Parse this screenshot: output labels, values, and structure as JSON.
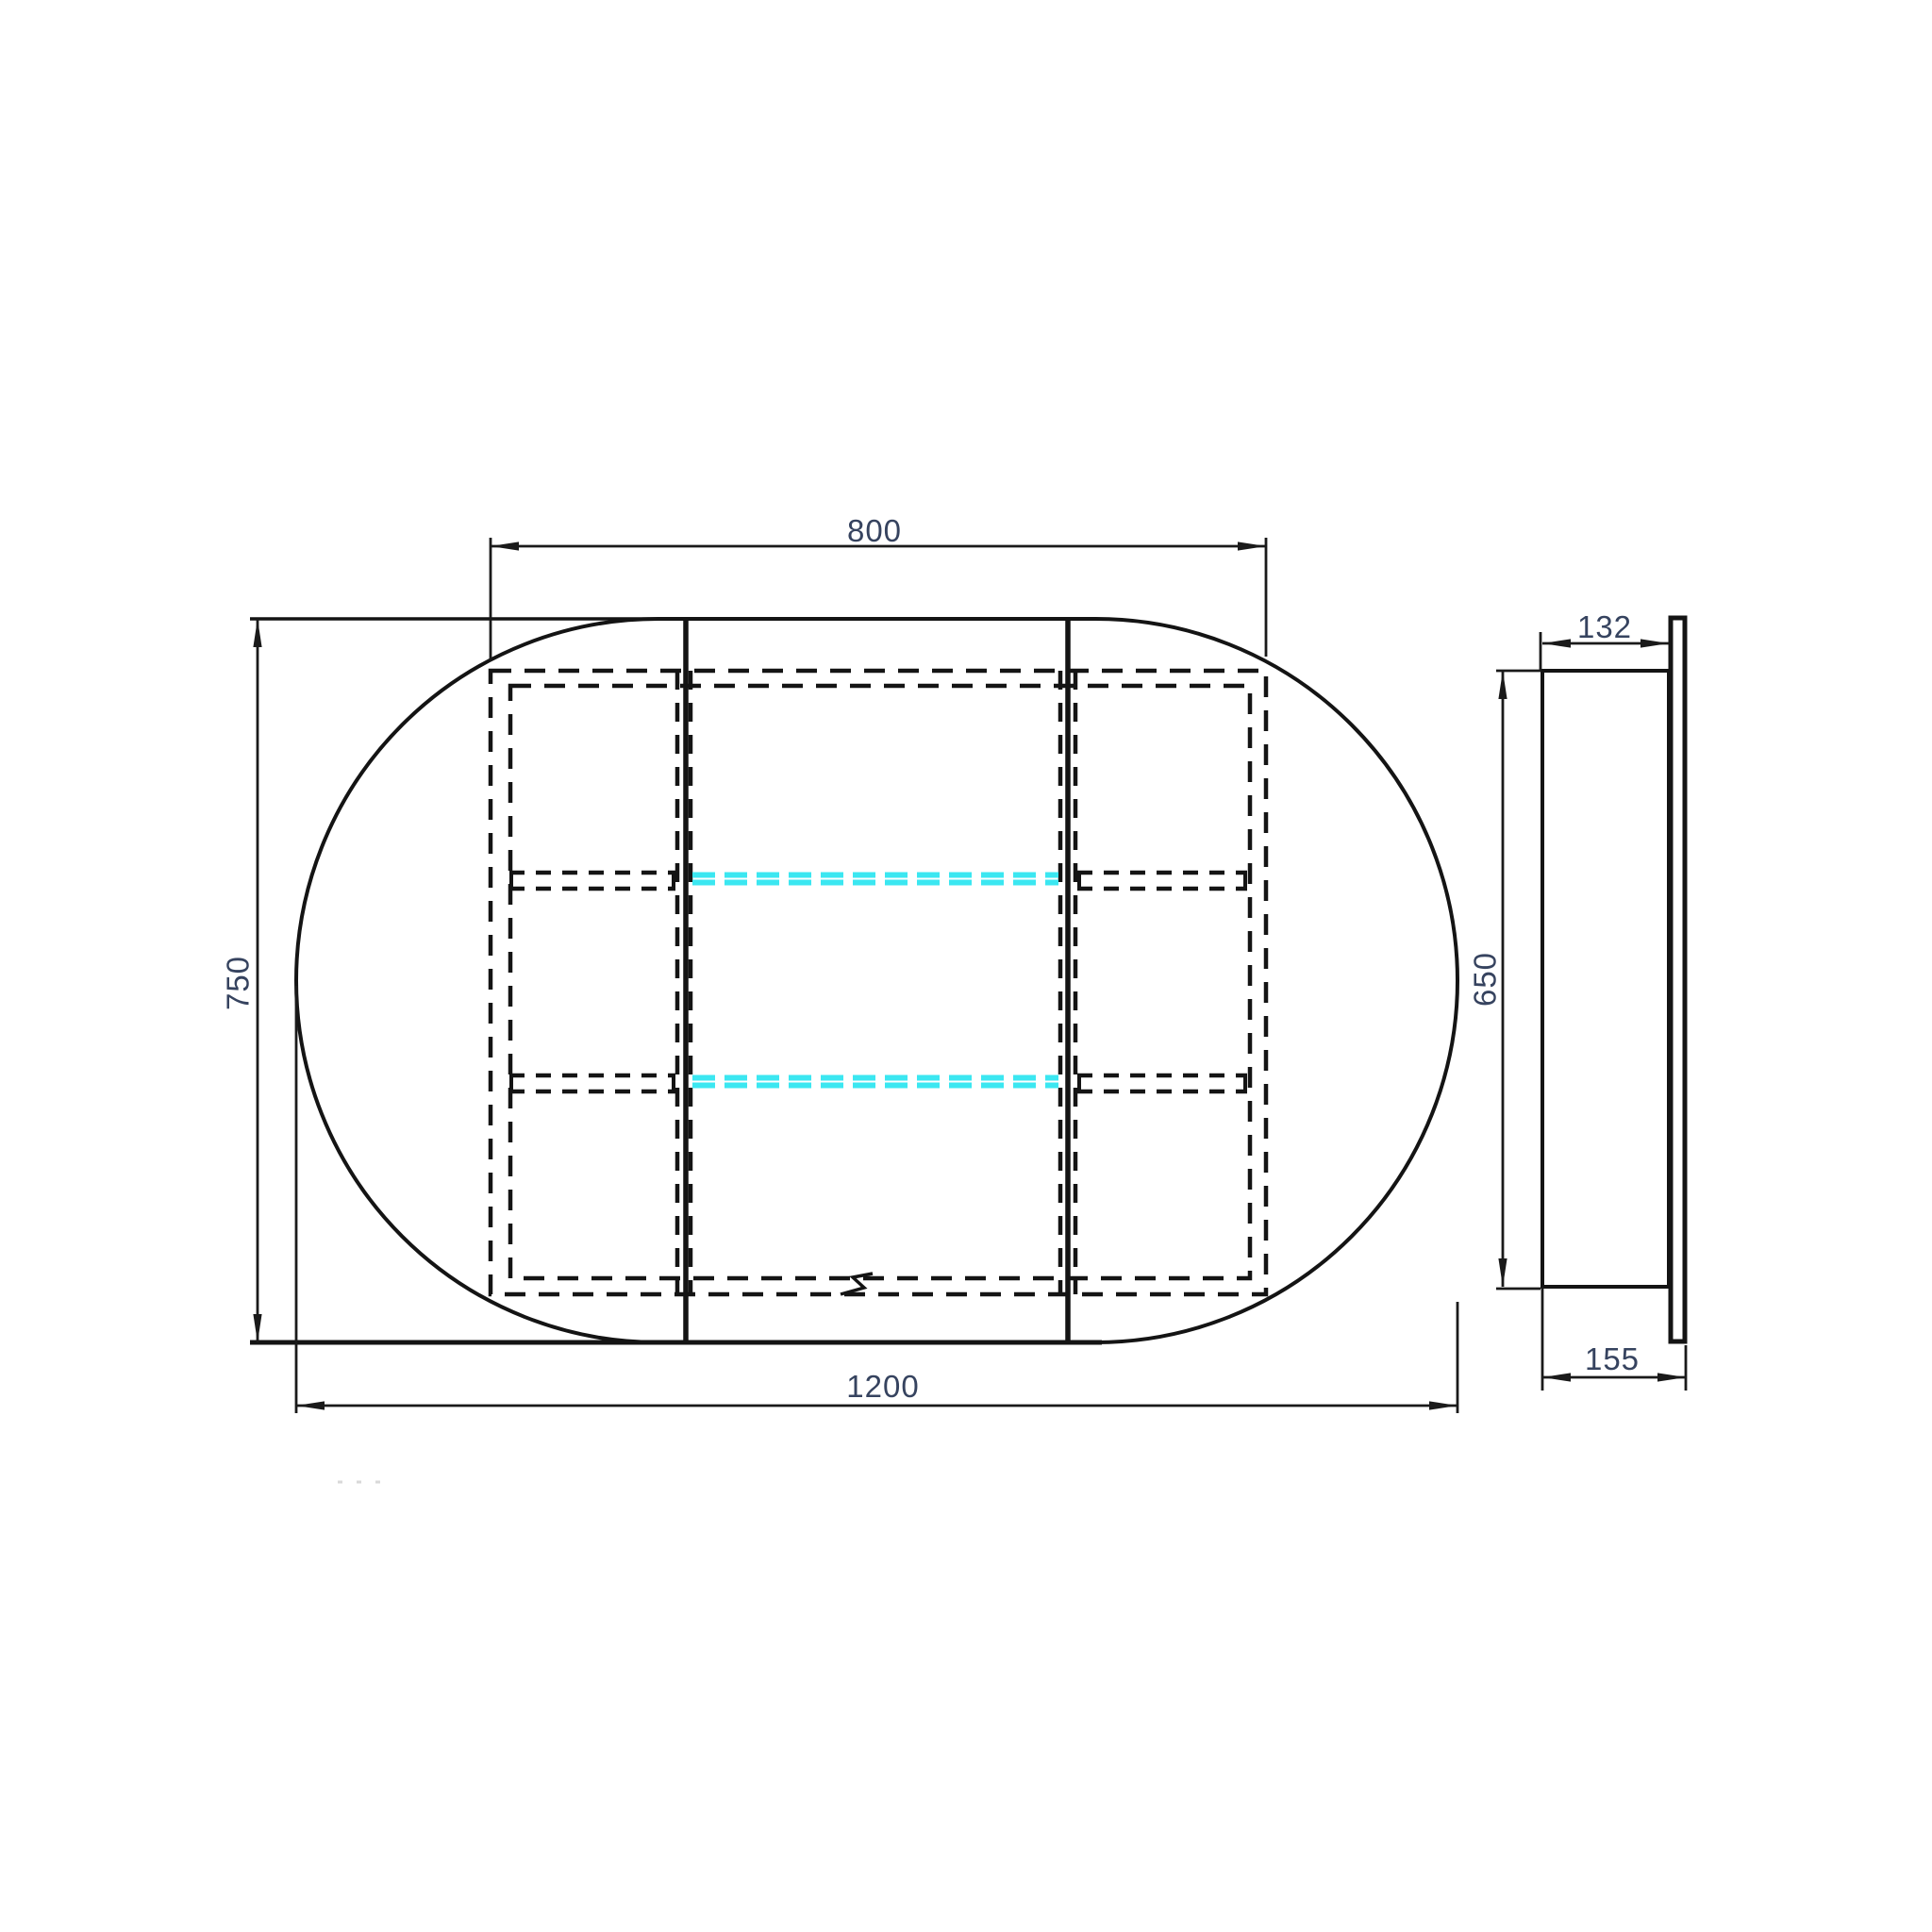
{
  "front_view": {
    "cabinet_width": "800",
    "overall_height": "750",
    "overall_width": "1200"
  },
  "side_view": {
    "cabinet_depth": "132",
    "cabinet_height": "650",
    "overall_depth": "155"
  },
  "colors": {
    "line": "#141414",
    "dimension_text": "#36435f",
    "glass_shelf": "#3BE7F1"
  }
}
